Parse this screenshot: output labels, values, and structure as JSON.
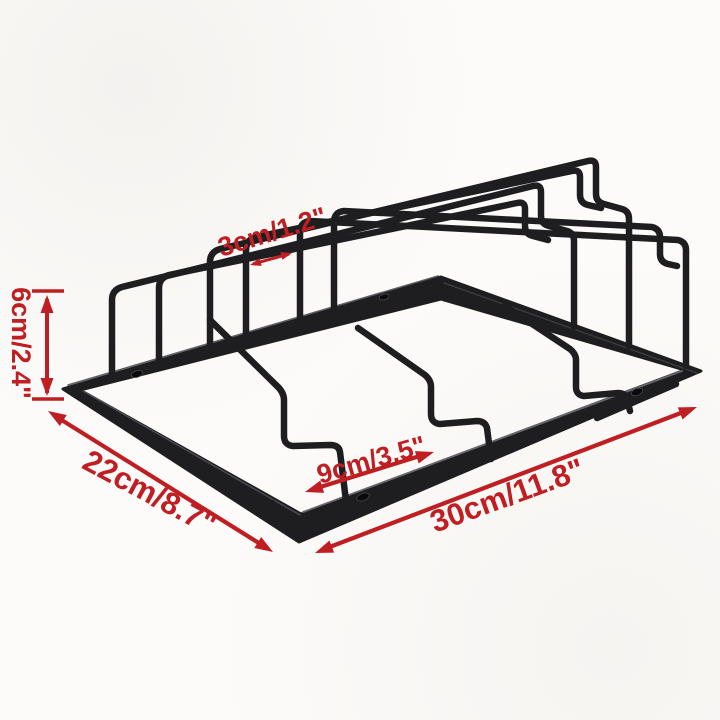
{
  "colors": {
    "annotation_red": "#bf1e22",
    "wire_black": "#1e1e21",
    "background": "#fbfaf8"
  },
  "illustration": {
    "subject": "under-cabinet wine glass stemware rack, black metal wireframe, perspective view"
  },
  "dimensions": {
    "slot_width": "3cm/1.2\"",
    "height": "6cm/2.4\"",
    "depth": "22cm/8.7\"",
    "slot_spacing": "9cm/3.5\"",
    "length": "30cm/11.8\""
  }
}
